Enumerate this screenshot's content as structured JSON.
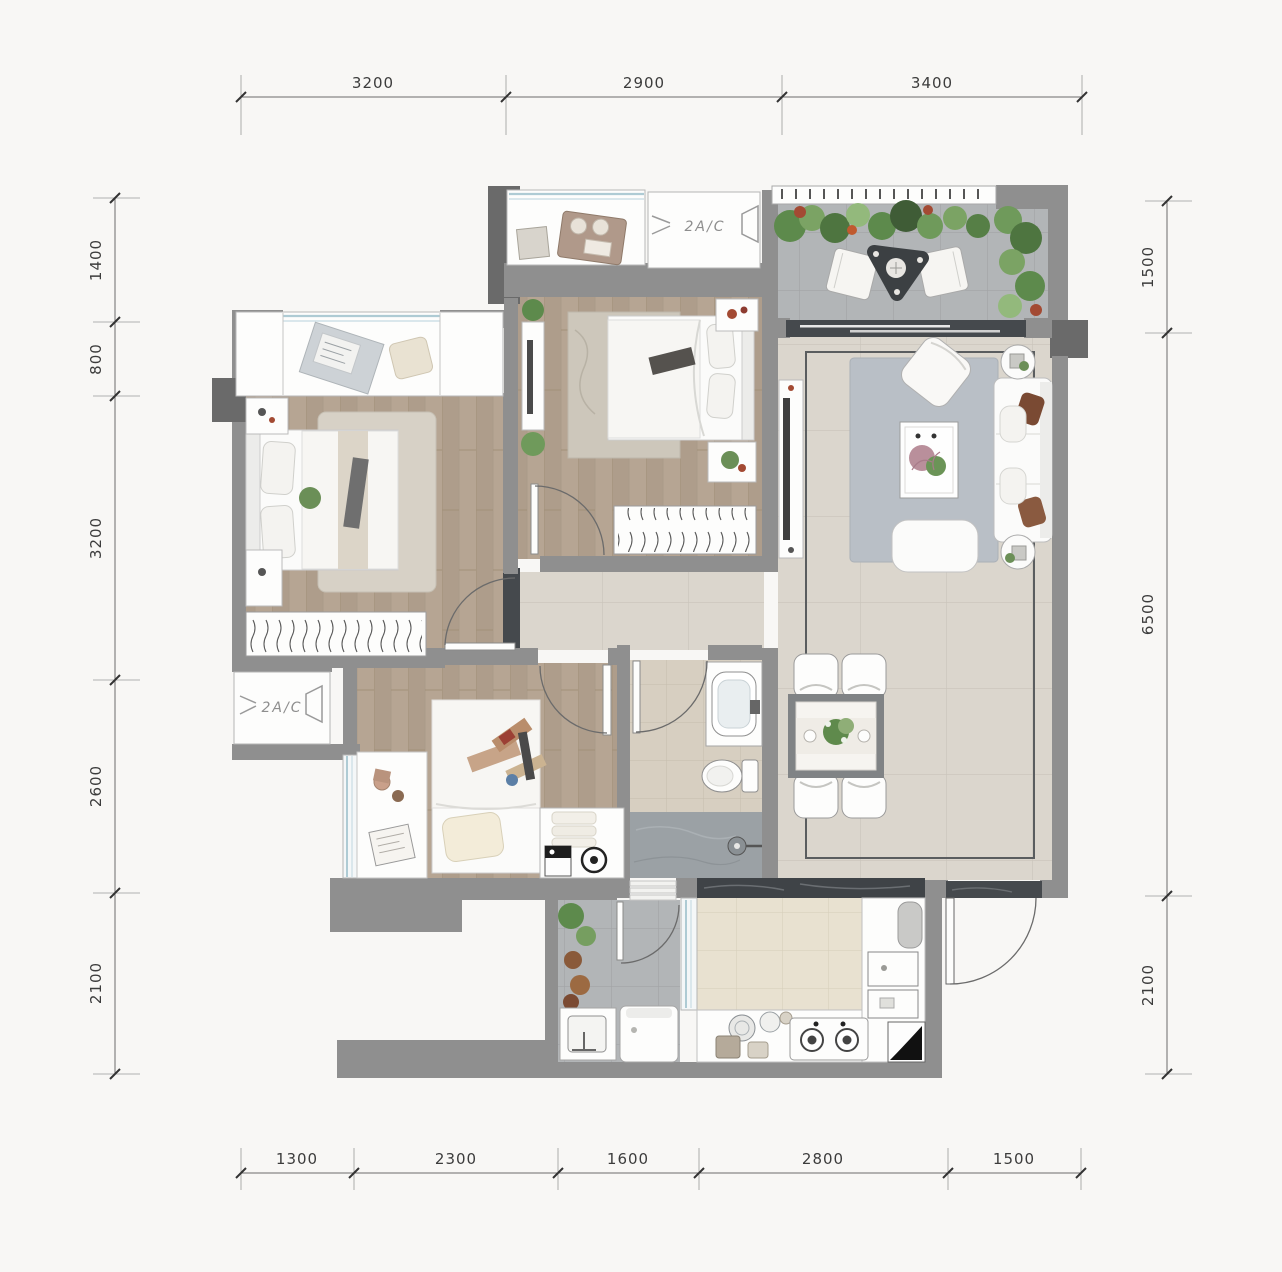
{
  "canvas": {
    "width": 1282,
    "height": 1272,
    "background": "#f8f7f5"
  },
  "dimensions": {
    "top": [
      "3200",
      "2900",
      "3400"
    ],
    "bottom": [
      "1300",
      "2300",
      "1600",
      "2800",
      "1500"
    ],
    "left": [
      "1400",
      "800",
      "3200",
      "2600",
      "2100"
    ],
    "right": [
      "1500",
      "6500",
      "2100"
    ]
  },
  "labels": {
    "ac_platform_top": "2A/C",
    "ac_platform_bottom_left": "2A/C"
  },
  "palette": {
    "wall": "#8f8f8f",
    "wall_dark": "#6a6a6a",
    "wood_floor": "#b6a593",
    "tile_floor": "#dbd6cd",
    "balcony_tile": "#b2b5b7",
    "bath_tile": "#d7cfc1",
    "shower_tile": "#9ba1a5",
    "kitchen_tile": "#e8e1d0",
    "rug_living": "#b9bfc6",
    "rug_bedroom": "#d7d1c6",
    "marble_dark": "#45494d",
    "glass": "#aecbd4",
    "plant_green": "#5d8a4c",
    "accent_red": "#a34a33",
    "dim_line": "#6b6b6b",
    "dim_text": "#3c3c3c"
  }
}
